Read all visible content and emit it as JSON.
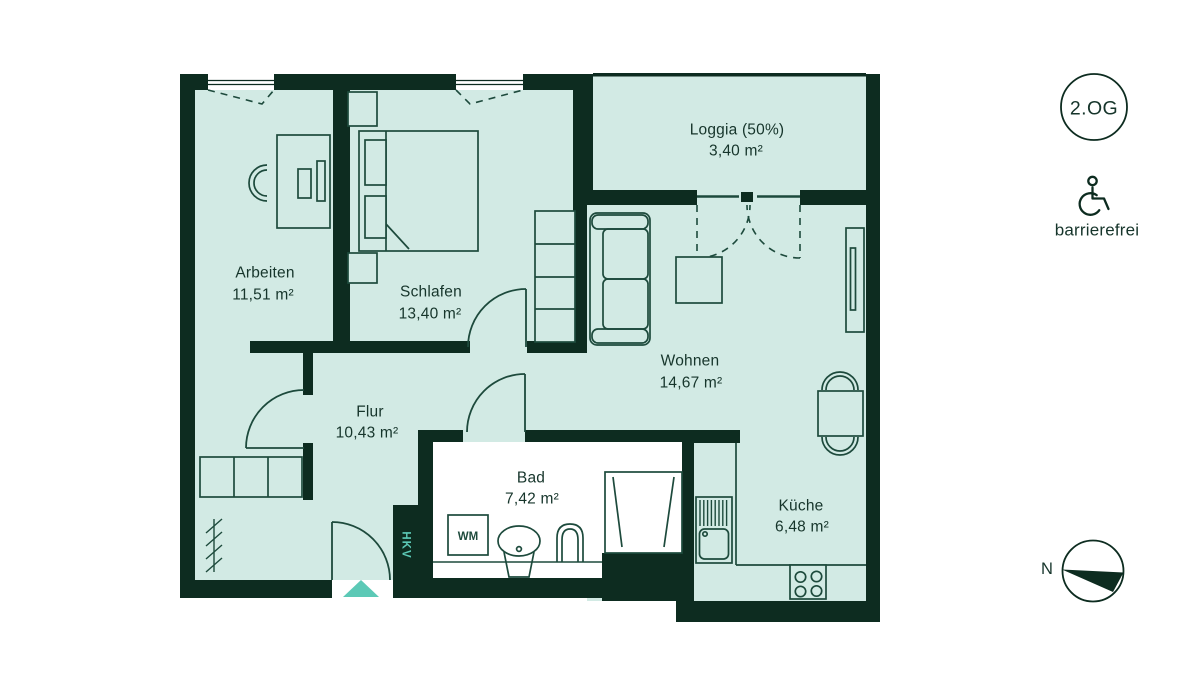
{
  "floor_badge": {
    "label": "2.OG"
  },
  "accessibility": {
    "label": "barrierefrei"
  },
  "compass": {
    "label": "N"
  },
  "rooms": {
    "arbeiten": {
      "name": "Arbeiten",
      "area": "11,51 m²"
    },
    "schlafen": {
      "name": "Schlafen",
      "area": "13,40 m²"
    },
    "loggia": {
      "name": "Loggia (50%)",
      "area": "3,40 m²"
    },
    "wohnen": {
      "name": "Wohnen",
      "area": "14,67 m²"
    },
    "flur": {
      "name": "Flur",
      "area": "10,43 m²"
    },
    "bad": {
      "name": "Bad",
      "area": "7,42 m²"
    },
    "kueche": {
      "name": "Küche",
      "area": "6,48 m²"
    }
  },
  "annotations": {
    "hkv": "HKV",
    "wm": "WM"
  },
  "colors": {
    "wall": "#0d2c20",
    "floor": "#d2eae4",
    "furniture_stroke": "#1d4a3c",
    "accent_teal": "#5cc9b6",
    "bad_floor": "#ffffff"
  }
}
